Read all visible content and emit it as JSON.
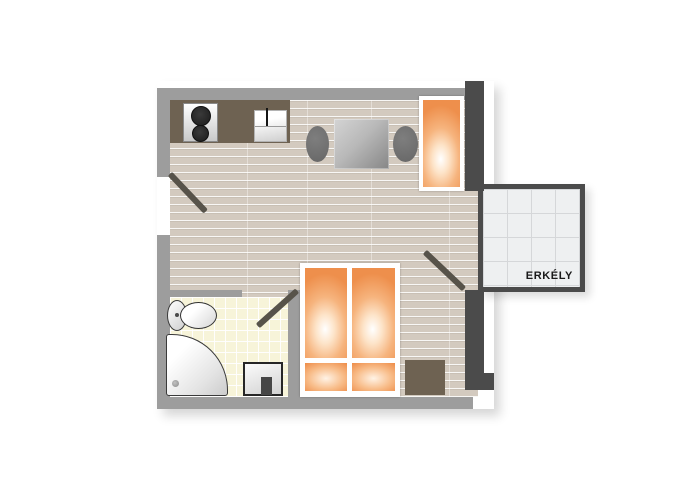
{
  "floorplan": {
    "balcony_label": "ERKÉLY",
    "furniture_icons": [
      "cooktop-icon",
      "kitchen-sink-icon",
      "dining-table-icon",
      "chair-icon",
      "wardrobe-icon",
      "bed-icon",
      "pillow-icon",
      "nightstand-icon",
      "toilet-icon",
      "shower-icon",
      "washbasin-icon",
      "door-swing-icon",
      "balcony-tiles-icon",
      "wood-floor-icon"
    ],
    "colors": {
      "wall": "#9d9d9d",
      "wall_dark": "#4b4b4b",
      "floor": "#d3cabf",
      "counter": "#6e6252",
      "orange_edge": "#ee8f4c",
      "orange_mid": "#f6b47e",
      "bath_tile": "#f7f4d9",
      "balcony_tile": "#eef0f1",
      "balcony_grid": "#d5d7d9",
      "chair": "#666666",
      "door": "#57534a",
      "label": "#1a1a1a"
    }
  }
}
